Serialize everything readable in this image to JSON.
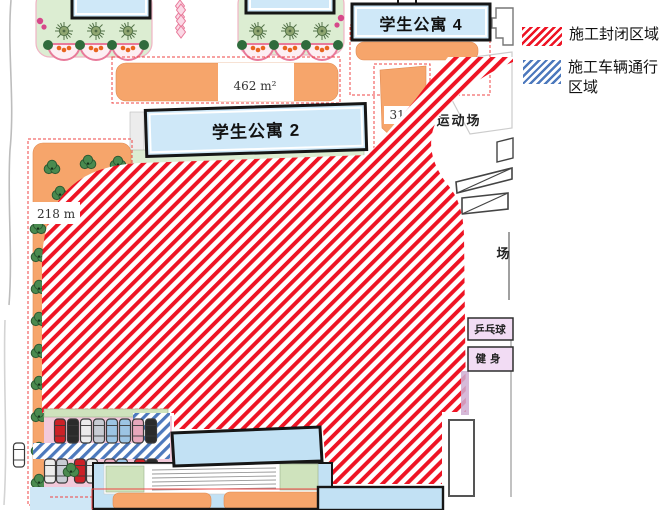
{
  "legend": {
    "items": [
      {
        "swatch_color": "#ee1424",
        "label": "施工封闭区域"
      },
      {
        "swatch_color": "#4d79bd",
        "label_line1": "施工车辆通行",
        "label_line2": "区域"
      }
    ]
  },
  "map": {
    "buildings": {
      "apartment4": "学生公寓 4",
      "apartment2": "学生公寓 2"
    },
    "areas": {
      "area462": "462 m²",
      "area313": "313",
      "area218": "218 m",
      "sports_field": "运动场",
      "field_char": "场",
      "pingpong": "乒乓球",
      "fitness": "健身"
    },
    "colors": {
      "closed_area_hatch": "#ee1424",
      "vehicle_area_hatch": "#4d79bd",
      "building_fill": "#cfe8f8",
      "orange_fill": "#f6a56b",
      "garden_fill": "#dcedd2",
      "parking_fill": "#f2c9da"
    }
  }
}
